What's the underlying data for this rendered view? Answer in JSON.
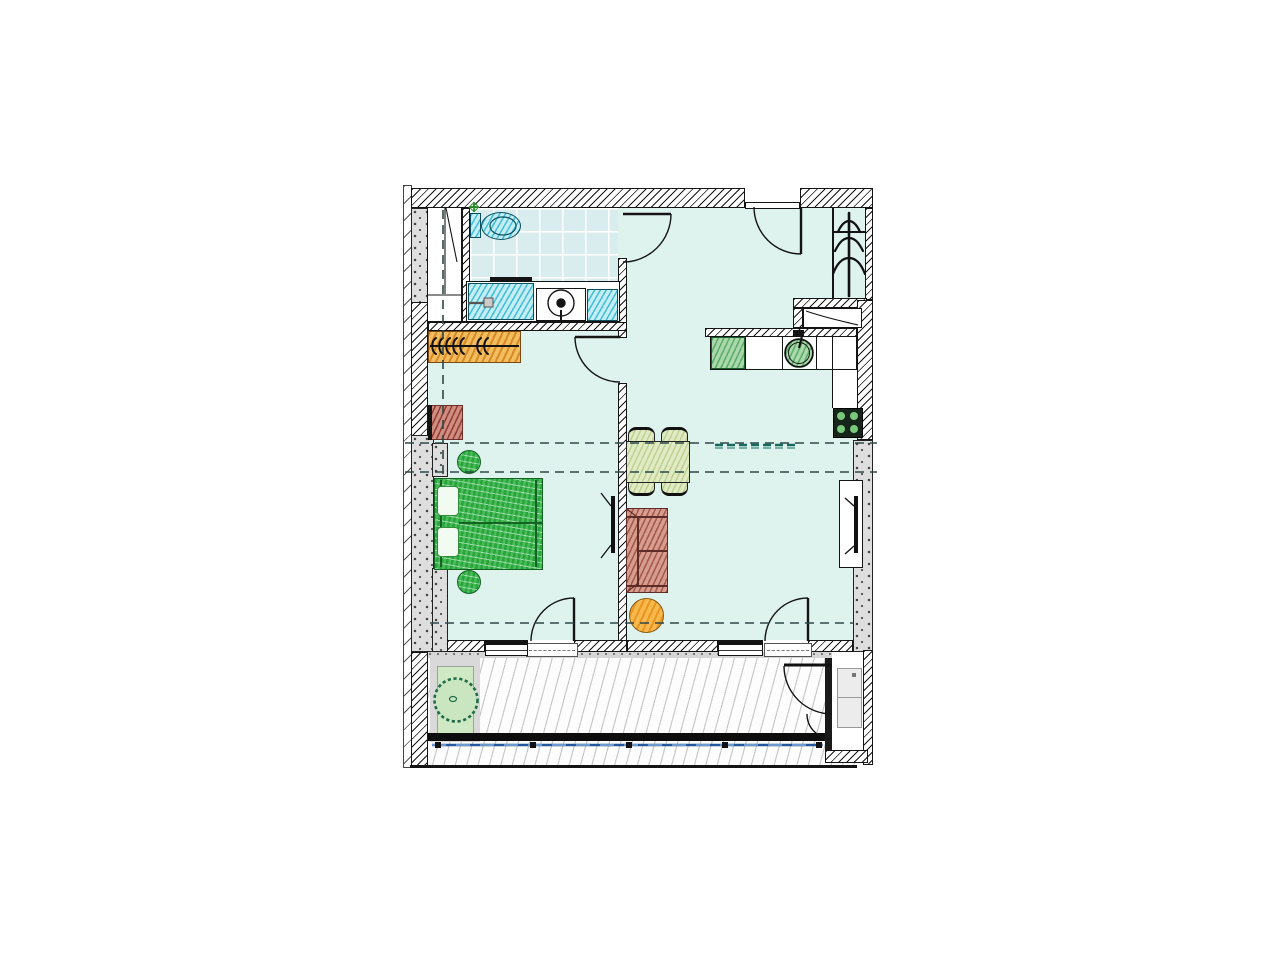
{
  "document": {
    "kind": "architectural floor plan",
    "description": "One-bedroom apartment plan with bathroom, hall, kitchen-living room, bedroom and a full-width balcony with wood decking",
    "text_labels": []
  },
  "rooms": [
    {
      "name": "bathroom",
      "position": "top-left",
      "features": [
        "tiled floor",
        "toilet",
        "vanity with two basins",
        "washing machine",
        "tall shaft cabinet"
      ]
    },
    {
      "name": "hall",
      "position": "top-center",
      "features": [
        "entrance door",
        "coat rack",
        "shoe cabinet niche"
      ]
    },
    {
      "name": "kitchen-living-room",
      "position": "right",
      "features": [
        "kitchen counter with sink",
        "stove",
        "dining table with four chairs",
        "sofa",
        "round coffee table",
        "wall TV",
        "balcony door with window"
      ]
    },
    {
      "name": "bedroom",
      "position": "left",
      "features": [
        "double bed with two pillows",
        "two round poufs",
        "wardrobe with hangers",
        "small desk",
        "wall TV",
        "balcony door with window"
      ]
    },
    {
      "name": "balcony",
      "position": "bottom",
      "features": [
        "wood decking",
        "potted plant on mat",
        "storage closet with shelf",
        "blue railing"
      ]
    }
  ],
  "palette": {
    "ink": "#141414",
    "concrete": "#dedede",
    "floor": "#def2ee",
    "tile_bg": "#d9edef",
    "tile_line": "#ffffff",
    "fixture": "#3fbfd8",
    "fixture_bg": "#c6edf4",
    "wardrobe": "#d2821a",
    "wardrobe_bg": "#f3bc5e",
    "desk": "#82281e",
    "desk_bg": "#cf8d82",
    "bed": "#27a53c",
    "bed_bg": "#49bc59",
    "bed_edge": "#136422",
    "dining": "#9cb764",
    "dining_bg": "#e0ebc4",
    "sofa": "#8c3c2d",
    "sofa_bg": "#d69c90",
    "sofa_edge": "#5f2d26",
    "rtable": "#e68c14",
    "rtable_bg": "#f7b94e",
    "kitchen": "#288c3c",
    "kitchen_bg": "#a9d9ab",
    "stove_bg": "#16251a",
    "burner": "#79c97c",
    "plant_line": "#1f6b45",
    "plant_bg": "#c9e6c0",
    "planter_bg": "#cfe9c4",
    "mat": "#d9d9d9",
    "railing": "#24589c",
    "railing_dash": "#9cc0e8",
    "deck_line": "#c9c9c9",
    "dash": "#2e4747",
    "kdash": "#17695a",
    "band": "#0d0d0d"
  }
}
